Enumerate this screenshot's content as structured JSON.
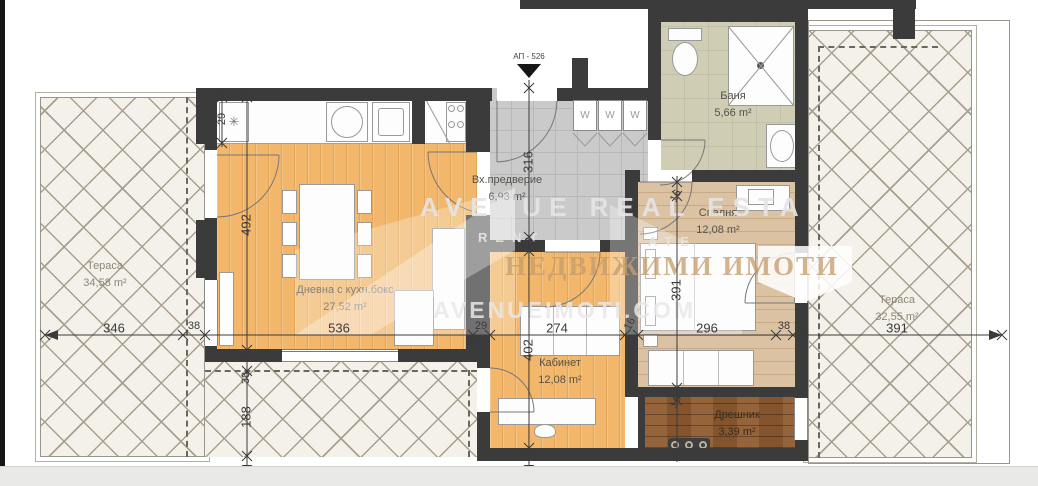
{
  "entrance": {
    "label": "АП - 526"
  },
  "wardrobe": {
    "label": "W"
  },
  "watermark": {
    "line1": "AVENUE REAL ESTA",
    "line2a": "RENT",
    "line2b": "ATE",
    "line3": "НЕДВИЖИМИ ИМОТИ",
    "line4": "AVENUEIMOTI.COM"
  },
  "rooms": {
    "terrace_left": {
      "name": "Тераса",
      "area": "34,58 m²"
    },
    "living": {
      "name": "Дневна с кухн.бокс",
      "area": "27,52 m²"
    },
    "entry": {
      "name": "Вх.предверие",
      "area": "6,93 m²"
    },
    "bath": {
      "name": "Баня",
      "area": "5,66 m²"
    },
    "bedroom": {
      "name": "Спалня",
      "area": "12,08 m²"
    },
    "office": {
      "name": "Кабинет",
      "area": "12,08 m²"
    },
    "closet": {
      "name": "Дрешник",
      "area": "3,39 m²"
    },
    "terrace_right": {
      "name": "Тераса",
      "area": "32,55 m²"
    }
  },
  "dims": {
    "t346": "346",
    "g38": "38",
    "l536": "536",
    "lw29": "29",
    "o274": "274",
    "ow16": "16",
    "b296": "296",
    "bw38": "38",
    "t391": "391",
    "k29": "29",
    "l492": "492",
    "lb38": "38",
    "s188": "188",
    "e316": "316",
    "ew16": "16",
    "o402": "402",
    "bt16": "16",
    "b391": "391",
    "cw16": "16"
  }
}
